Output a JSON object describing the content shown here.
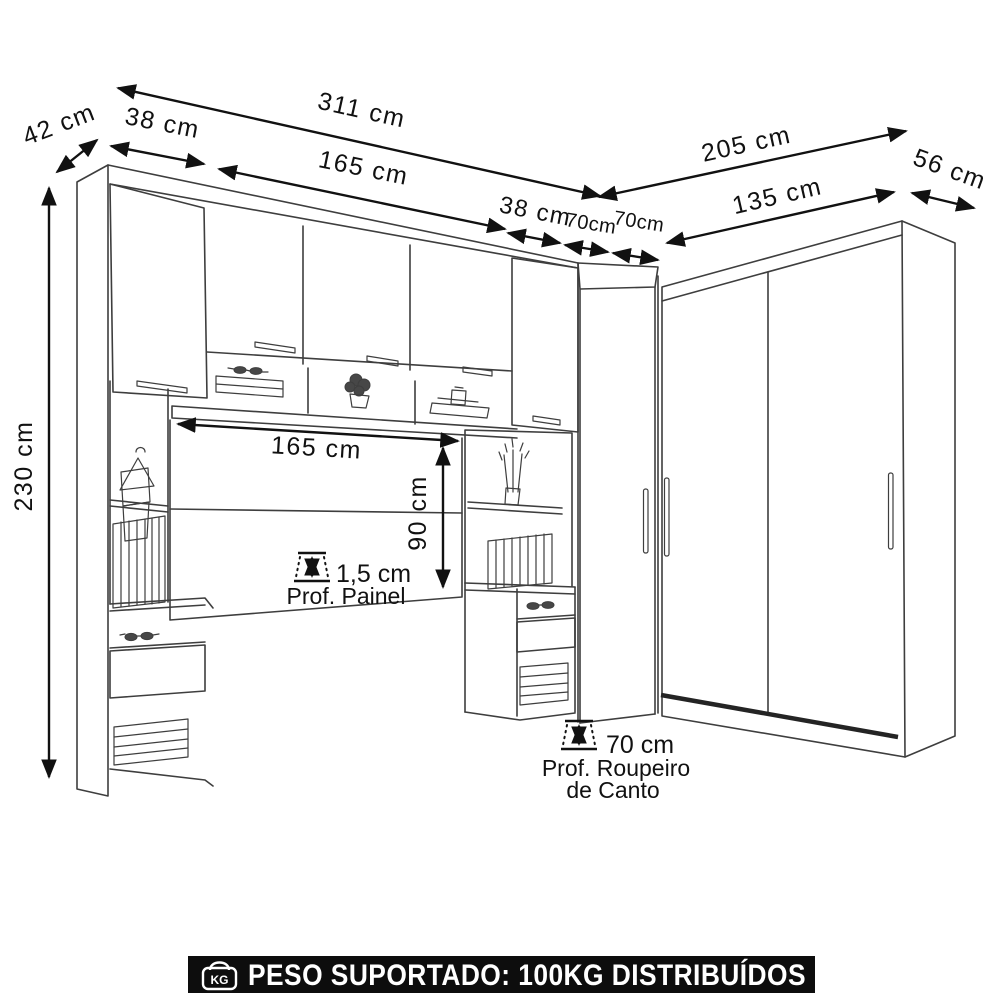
{
  "dims": {
    "total_width": "311 cm",
    "side_depth_left": "42 cm",
    "door_left": "38 cm",
    "bridge_top": "165 cm",
    "door_right": "38 cm",
    "corner_front_a": "70cm",
    "corner_front_b": "70cm",
    "right_total": "205 cm",
    "wardrobe_width": "135 cm",
    "wardrobe_depth": "56 cm",
    "height": "230 cm",
    "bed_width": "165 cm",
    "bed_panel_height": "90 cm"
  },
  "panel_note": {
    "value": "1,5 cm",
    "label": "Prof. Painel"
  },
  "corner_note": {
    "value": "70 cm",
    "line1": "Prof. Roupeiro",
    "line2": "de Canto"
  },
  "banner": {
    "text": "PESO SUPORTADO: 100KG DISTRIBUÍDOS",
    "kg_label": "KG"
  },
  "colors": {
    "background": "#ffffff",
    "line": "#3e3e3e",
    "arrow": "#111111",
    "banner_bg": "#0d0d0d",
    "banner_fg": "#ffffff"
  }
}
